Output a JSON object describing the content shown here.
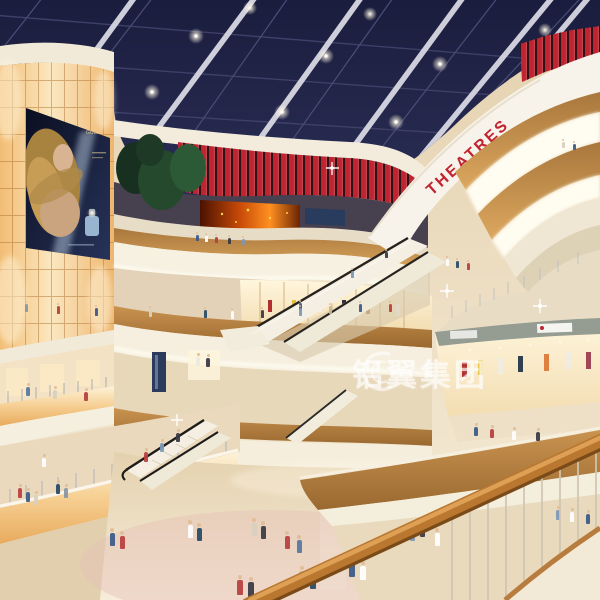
{
  "scene": {
    "title": "Shopping mall atrium interior rendering",
    "setting": "Multi-level retail atrium with dark glass skylight, lit structural beams, curved cream balconies with wood trim, escalators, glowing amber panel wall with cosmetics advertisement, cinema level with red fins, and crowds of shoppers",
    "floors_visible": 5,
    "signs": {
      "theatre_sign": "THEATRES",
      "watermark": "铝翼集团",
      "ad_poster_brand": "GUERLAIN"
    },
    "palette": {
      "skylight_navy": "#1c1f40",
      "sign_red": "#c22331",
      "wood_trim": "#c08a4e",
      "glow_amber": "#f6cf92",
      "cream_white": "#f5efe2",
      "floor_beige": "#ead9bc"
    },
    "people": [
      {
        "x": 197,
        "y": 241,
        "h": 6,
        "c": "#3c5a88"
      },
      {
        "x": 206,
        "y": 242,
        "h": 6,
        "c": "#ffffff"
      },
      {
        "x": 216,
        "y": 243,
        "h": 6,
        "c": "#b84040"
      },
      {
        "x": 229,
        "y": 244,
        "h": 6,
        "c": "#3a3a44"
      },
      {
        "x": 243,
        "y": 245,
        "h": 6,
        "c": "#7c98b8"
      },
      {
        "x": 563,
        "y": 148,
        "h": 6,
        "c": "#d8d0c0"
      },
      {
        "x": 574,
        "y": 150,
        "h": 6,
        "c": "#3c5a88"
      },
      {
        "x": 447,
        "y": 266,
        "h": 7,
        "c": "#ffffff"
      },
      {
        "x": 457,
        "y": 268,
        "h": 7,
        "c": "#274b66"
      },
      {
        "x": 468,
        "y": 270,
        "h": 7,
        "c": "#b84040"
      },
      {
        "x": 386,
        "y": 258,
        "h": 6,
        "c": "#3a3a44"
      },
      {
        "x": 352,
        "y": 278,
        "h": 7,
        "c": "#7c98b8"
      },
      {
        "x": 300,
        "y": 310,
        "h": 7,
        "c": "#3c5a88"
      },
      {
        "x": 26,
        "y": 312,
        "h": 8,
        "c": "#8898a8"
      },
      {
        "x": 58,
        "y": 314,
        "h": 8,
        "c": "#b84040"
      },
      {
        "x": 96,
        "y": 316,
        "h": 8,
        "c": "#3c5a88"
      },
      {
        "x": 150,
        "y": 317,
        "h": 8,
        "c": "#d8d0c0"
      },
      {
        "x": 205,
        "y": 318,
        "h": 8,
        "c": "#274b66"
      },
      {
        "x": 232,
        "y": 319,
        "h": 8,
        "c": "#ffffff"
      },
      {
        "x": 262,
        "y": 318,
        "h": 8,
        "c": "#3a3a44"
      },
      {
        "x": 300,
        "y": 316,
        "h": 8,
        "c": "#7c98b8"
      },
      {
        "x": 330,
        "y": 314,
        "h": 8,
        "c": "#c8b890"
      },
      {
        "x": 360,
        "y": 312,
        "h": 8,
        "c": "#3c5a88"
      },
      {
        "x": 390,
        "y": 312,
        "h": 8,
        "c": "#b84040"
      },
      {
        "x": 198,
        "y": 366,
        "h": 9,
        "c": "#eceadf"
      },
      {
        "x": 208,
        "y": 367,
        "h": 9,
        "c": "#3a3648"
      },
      {
        "x": 28,
        "y": 396,
        "h": 9,
        "c": "#5878a0"
      },
      {
        "x": 55,
        "y": 399,
        "h": 9,
        "c": "#d8d0c0"
      },
      {
        "x": 86,
        "y": 401,
        "h": 9,
        "c": "#b84040"
      },
      {
        "x": 476,
        "y": 436,
        "h": 9,
        "c": "#3c5a88"
      },
      {
        "x": 492,
        "y": 438,
        "h": 9,
        "c": "#b84040"
      },
      {
        "x": 514,
        "y": 440,
        "h": 9,
        "c": "#ffffff"
      },
      {
        "x": 538,
        "y": 441,
        "h": 9,
        "c": "#3a3a44"
      },
      {
        "x": 558,
        "y": 520,
        "h": 10,
        "c": "#7c98b8"
      },
      {
        "x": 572,
        "y": 522,
        "h": 10,
        "c": "#ffffff"
      },
      {
        "x": 588,
        "y": 524,
        "h": 10,
        "c": "#3c5a88"
      },
      {
        "x": 20,
        "y": 498,
        "h": 10,
        "c": "#b84040"
      },
      {
        "x": 28,
        "y": 502,
        "h": 10,
        "c": "#3c5a88"
      },
      {
        "x": 36,
        "y": 505,
        "h": 10,
        "c": "#d8d0c0"
      },
      {
        "x": 58,
        "y": 494,
        "h": 10,
        "c": "#274b66"
      },
      {
        "x": 66,
        "y": 498,
        "h": 10,
        "c": "#8898a8"
      },
      {
        "x": 44,
        "y": 467,
        "h": 9,
        "c": "#ffffff"
      },
      {
        "x": 178,
        "y": 442,
        "h": 9,
        "c": "#3a3a44"
      },
      {
        "x": 162,
        "y": 452,
        "h": 9,
        "c": "#7c98b8"
      },
      {
        "x": 146,
        "y": 462,
        "h": 10,
        "c": "#b84040"
      },
      {
        "x": 112,
        "y": 546,
        "h": 13,
        "c": "#3c5a88"
      },
      {
        "x": 122,
        "y": 549,
        "h": 13,
        "c": "#b84040"
      },
      {
        "x": 190,
        "y": 538,
        "h": 13,
        "c": "#ffffff"
      },
      {
        "x": 199,
        "y": 541,
        "h": 13,
        "c": "#274b66"
      },
      {
        "x": 254,
        "y": 536,
        "h": 13,
        "c": "#d8d0c0"
      },
      {
        "x": 263,
        "y": 539,
        "h": 13,
        "c": "#3a3a44"
      },
      {
        "x": 287,
        "y": 549,
        "h": 13,
        "c": "#b84040"
      },
      {
        "x": 299,
        "y": 553,
        "h": 13,
        "c": "#5878a0"
      },
      {
        "x": 352,
        "y": 577,
        "h": 14,
        "c": "#3c5a88"
      },
      {
        "x": 363,
        "y": 580,
        "h": 14,
        "c": "#ffffff"
      },
      {
        "x": 302,
        "y": 586,
        "h": 15,
        "c": "#c8b890"
      },
      {
        "x": 313,
        "y": 589,
        "h": 15,
        "c": "#274b66"
      },
      {
        "x": 240,
        "y": 595,
        "h": 15,
        "c": "#b84040"
      },
      {
        "x": 251,
        "y": 597,
        "h": 15,
        "c": "#3a3a44"
      },
      {
        "x": 412,
        "y": 541,
        "h": 13,
        "c": "#7c98b8"
      },
      {
        "x": 422,
        "y": 537,
        "h": 13,
        "c": "#3a3a44"
      },
      {
        "x": 437,
        "y": 546,
        "h": 13,
        "c": "#ffffff"
      }
    ]
  }
}
